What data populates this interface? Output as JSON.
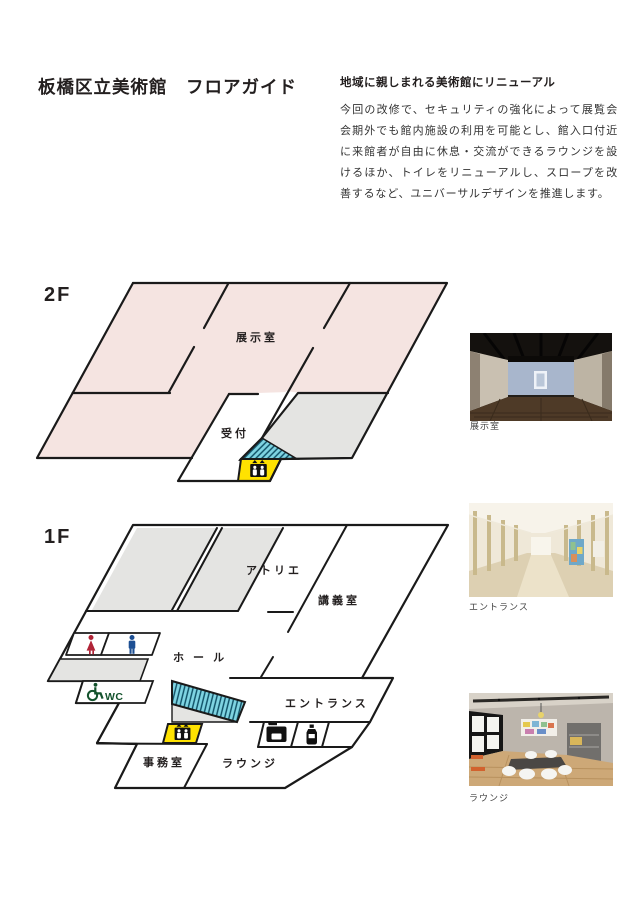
{
  "header": {
    "title": "板橋区立美術館　フロアガイド"
  },
  "intro": {
    "heading": "地域に親しまれる美術館にリニューアル",
    "body": "今回の改修で、セキュリティの強化によって展覧会会期外でも館内施設の利用を可能とし、館入口付近に来館者が自由に休息・交流ができるラウンジを設けるほか、トイレをリニューアルし、スロープを改善するなど、ユニバーサルデザインを推進します。"
  },
  "floors": {
    "f2": {
      "label": "2F",
      "rooms": {
        "exhibit": "展示室",
        "reception": "受付"
      }
    },
    "f1": {
      "label": "1F",
      "rooms": {
        "atelier": "アトリエ",
        "lecture": "講義室",
        "hall": "ホ ー ル",
        "entrance": "エントランス",
        "lounge": "ラウンジ",
        "office": "事務室",
        "wc_label": "WC"
      }
    }
  },
  "photos": [
    {
      "caption": "展示室"
    },
    {
      "caption": "エントランス"
    },
    {
      "caption": "ラウンジ"
    }
  ],
  "colors": {
    "pink": "#f5e4e1",
    "grey": "#e4e4e2",
    "yellow": "#ffe200",
    "hatch_base": "#7fd4e2",
    "hatch_line": "#0d4d63",
    "wall": "#1a1a1a",
    "woman": "#b02437",
    "man": "#1d4f93",
    "wc_green": "#14532d"
  }
}
